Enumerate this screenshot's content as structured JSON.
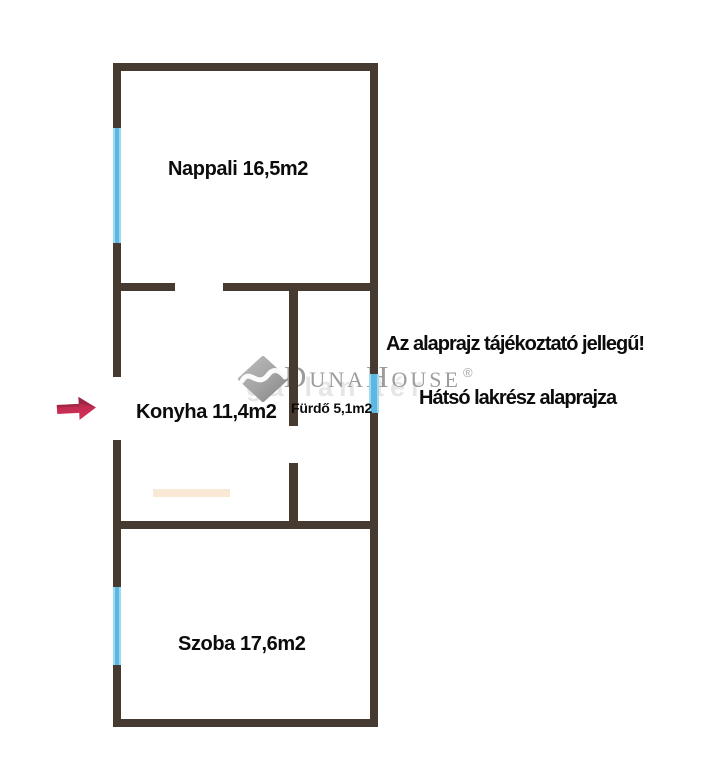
{
  "page": {
    "background": "#ffffff",
    "type_hint": "apartment floor plan"
  },
  "rooms": [
    {
      "id": "nappali",
      "label": "Nappali 16,5m2",
      "name": "Nappali",
      "area": "16,5m2"
    },
    {
      "id": "konyha",
      "label": "Konyha 11,4m2",
      "name": "Konyha",
      "area": "11,4m2"
    },
    {
      "id": "furdo",
      "label": "Fürdő 5,1m2",
      "name": "Fürdő",
      "area": "5,1m2"
    },
    {
      "id": "szoba",
      "label": "Szoba 17,6m2",
      "name": "Szoba",
      "area": "17,6m2"
    }
  ],
  "notes": {
    "disclaimer": "Az alaprajz tájékoztató jellegű!",
    "plan_title": "Hátsó lakrész alaprajza"
  },
  "watermark": {
    "brand": "DunaHouse",
    "registered_mark": "®",
    "echo_text": "gatlan tér",
    "logo": "diamond-swoosh-icon"
  },
  "icons": {
    "entrance_arrow": "right-block-arrow"
  },
  "colors": {
    "wall": "#473a31",
    "window": "#5cb8e0",
    "window_edge": "#9ed9f0",
    "arrow_main": "#c92e53",
    "arrow_dark": "#97253f",
    "text": "#0c0c0c",
    "watermark_gray": "#9c9c9c",
    "artifact_peach": "#f9e8d4"
  }
}
